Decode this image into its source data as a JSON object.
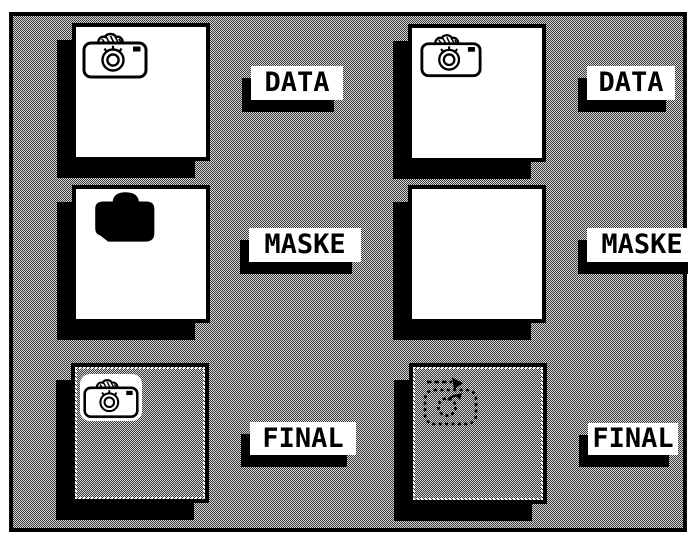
{
  "app": {
    "description": "Monochrome image-processing dialog with six image wells",
    "colors": {
      "frame": "#000000",
      "page_margin": "#ffffff",
      "tile_white": "#ffffff",
      "shadow": "#000000",
      "dither_dark": "#3a3a3a",
      "dither_light": "#d6d6d6"
    }
  },
  "panels": [
    {
      "id": "data-left",
      "label": "DATA",
      "icon": "camera-outline-icon",
      "surface": "white"
    },
    {
      "id": "maske-left",
      "label": "MASKE",
      "icon": "camera-solid-icon",
      "surface": "white"
    },
    {
      "id": "final-left",
      "label": "FINAL",
      "icon": "camera-outline-badge-icon",
      "surface": "dither"
    },
    {
      "id": "data-right",
      "label": "DATA",
      "icon": "camera-outline-icon",
      "surface": "white"
    },
    {
      "id": "maske-right",
      "label": "MASKE",
      "icon": "none",
      "surface": "white"
    },
    {
      "id": "final-right",
      "label": "FINAL",
      "icon": "camera-dotted-arrow-icon",
      "surface": "dither"
    }
  ]
}
